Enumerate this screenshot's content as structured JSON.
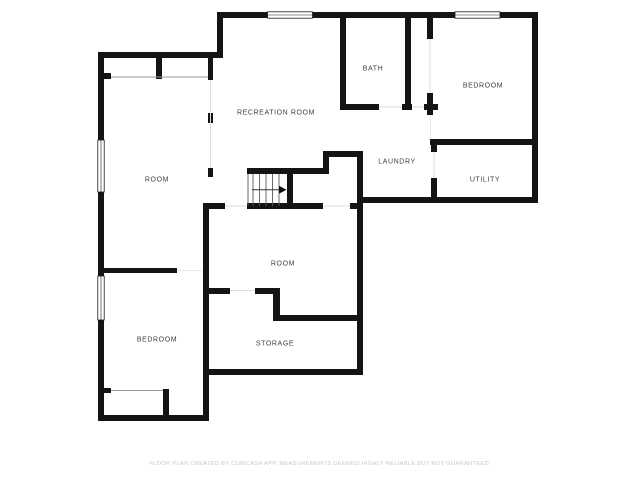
{
  "page": {
    "background": "#ffffff"
  },
  "floor_plan": {
    "rooms": [
      {
        "label": "RECREATION ROOM"
      },
      {
        "label": "BATH"
      },
      {
        "label": "BEDROOM"
      },
      {
        "label": "LAUNDRY"
      },
      {
        "label": "UTILITY"
      },
      {
        "label": "ROOM"
      },
      {
        "label": "ROOM"
      },
      {
        "label": "BEDROOM"
      },
      {
        "label": "STORAGE"
      }
    ],
    "colors": {
      "wall": "#141414",
      "room_label": "#3d3d3d",
      "opening_line": "#dcdcdc",
      "closet_line": "#9a9a9a",
      "stair_tread": "#5a5a5a",
      "footer_text": "#c9c9c9",
      "background": "#ffffff"
    },
    "symbols": {
      "windows_count": 4,
      "stairs_direction": "right"
    }
  },
  "footer": {
    "disclaimer": "FLOOR PLAN CREATED BY CUBICASA APP. MEASUREMENTS DEEMED HIGHLY RELIABLE BUT NOT GUARANTEED."
  }
}
